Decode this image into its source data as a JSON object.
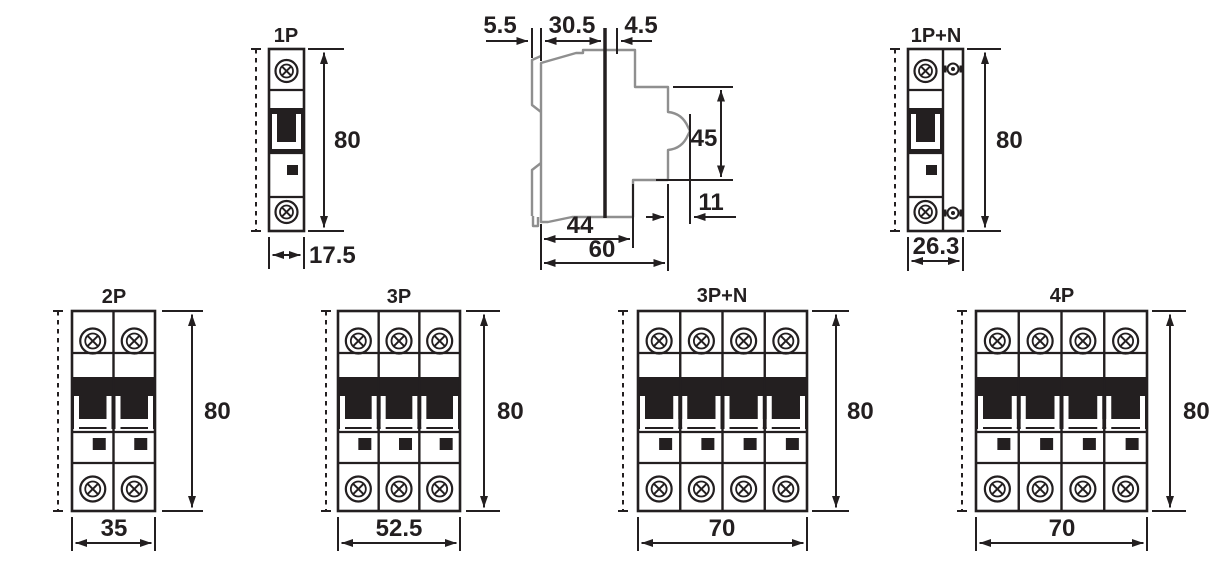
{
  "colors": {
    "line": "#231f20",
    "side_outline": "#8f8f8f",
    "background": "#ffffff"
  },
  "views": {
    "front_1p": {
      "title": "1P",
      "dim_height": "80",
      "dim_width": "17.5"
    },
    "front_1pn": {
      "title": "1P+N",
      "dim_height": "80",
      "dim_width": "26.3"
    },
    "front_2p": {
      "title": "2P",
      "dim_height": "80",
      "dim_width": "35"
    },
    "front_3p": {
      "title": "3P",
      "dim_height": "80",
      "dim_width": "52.5"
    },
    "front_3pn": {
      "title": "3P+N",
      "dim_height": "80",
      "dim_width": "70"
    },
    "front_4p": {
      "title": "4P",
      "dim_height": "80",
      "dim_width": "70"
    },
    "side": {
      "dim_rail_offset": "5.5",
      "dim_top_depth": "30.5",
      "dim_front_offset": "4.5",
      "dim_face_height": "45",
      "dim_lever_projection": "11",
      "dim_body_depth": "44",
      "dim_total_depth": "60"
    }
  }
}
